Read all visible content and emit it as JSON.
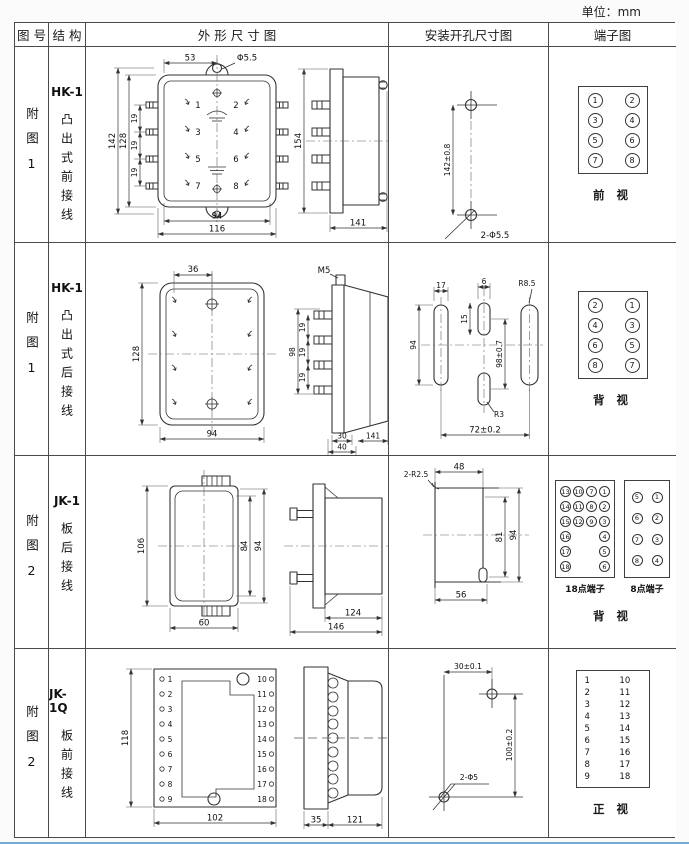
{
  "unit_label": "单位：mm",
  "page": {
    "accent_rule_color": "#5b9bd5",
    "line_color": "#333333",
    "border_color": "#4a4a4a"
  },
  "headers": {
    "figure": "图 号",
    "structure": "结 构",
    "outline": "外 形 尺 寸 图",
    "mounting": "安装开孔尺寸图",
    "terminal": "端子图"
  },
  "rows": [
    {
      "figure": "附图1",
      "model": "HK-1",
      "desc": "凸出式前接线",
      "outline": {
        "w_top": "53",
        "hole": "Φ5.5",
        "h_overall": "142",
        "h_body": "128",
        "pitch": "19",
        "w_inner": "94",
        "w_outer": "116",
        "side_h": "154",
        "side_d": "141",
        "pins": [
          "1",
          "2",
          "3",
          "4",
          "5",
          "6",
          "7",
          "8"
        ]
      },
      "mounting": {
        "v_span": "142±0.8",
        "holes": "2-Φ5.5"
      },
      "terminal": {
        "caption": "前 视",
        "grid": [
          "1",
          "2",
          "3",
          "4",
          "5",
          "6",
          "7",
          "8"
        ]
      }
    },
    {
      "figure": "附图1",
      "model": "HK-1",
      "desc": "凸出式后接线",
      "outline": {
        "w_top": "36",
        "h_body": "128",
        "w_inner": "94",
        "thread": "M5",
        "studs_h": "98",
        "pitch": "19",
        "d_small": "30",
        "d_mid": "40",
        "side_d": "141"
      },
      "mounting": {
        "slot_w": "17",
        "slot_h": "94",
        "mid_w": "6",
        "mid_h": "15",
        "mid_span": "98±0.7",
        "h_span": "72±0.2",
        "r_outer": "R8.5",
        "r_mid": "R3"
      },
      "terminal": {
        "caption": "背 视",
        "grid": [
          "2",
          "1",
          "4",
          "3",
          "6",
          "5",
          "8",
          "7"
        ]
      }
    },
    {
      "figure": "附图2",
      "model": "JK-1",
      "desc": "板后接线",
      "outline": {
        "h_overall": "106",
        "w": "60",
        "h_inner": "84",
        "h_outer": "94",
        "d_body": "124",
        "d_total": "146"
      },
      "mounting": {
        "radius": "2-R2.5",
        "w_top": "48",
        "h_inner": "81",
        "h_outer": "94",
        "w_bottom": "56"
      },
      "terminal": {
        "caption": "背 视",
        "label18": "18点端子",
        "label8": "8点端子",
        "grid18": [
          "13",
          "10",
          "7",
          "1",
          "14",
          "11",
          "8",
          "2",
          "15",
          "12",
          "9",
          "3",
          "16",
          "",
          "",
          "4",
          "17",
          "",
          "",
          "5",
          "18",
          "",
          "",
          "6"
        ],
        "grid8": [
          "5",
          "1",
          "6",
          "2",
          "7",
          "3",
          "8",
          "4"
        ]
      }
    },
    {
      "figure": "附图2",
      "model": "JK-1Q",
      "desc": "板前接线",
      "outline": {
        "h": "118",
        "w": "102",
        "d_plate": "35",
        "d_body": "121",
        "pins_left": [
          "1",
          "2",
          "3",
          "4",
          "5",
          "6",
          "7",
          "8",
          "9"
        ],
        "pins_right": [
          "10",
          "11",
          "12",
          "13",
          "14",
          "15",
          "16",
          "17",
          "18"
        ]
      },
      "mounting": {
        "h_span": "30±0.1",
        "v_span": "100±0.2",
        "holes": "2-Φ5"
      },
      "terminal": {
        "caption": "正 视",
        "col_left": [
          "1",
          "2",
          "3",
          "4",
          "5",
          "6",
          "7",
          "8",
          "9"
        ],
        "col_right": [
          "10",
          "11",
          "12",
          "13",
          "14",
          "15",
          "16",
          "17",
          "18"
        ]
      }
    }
  ]
}
